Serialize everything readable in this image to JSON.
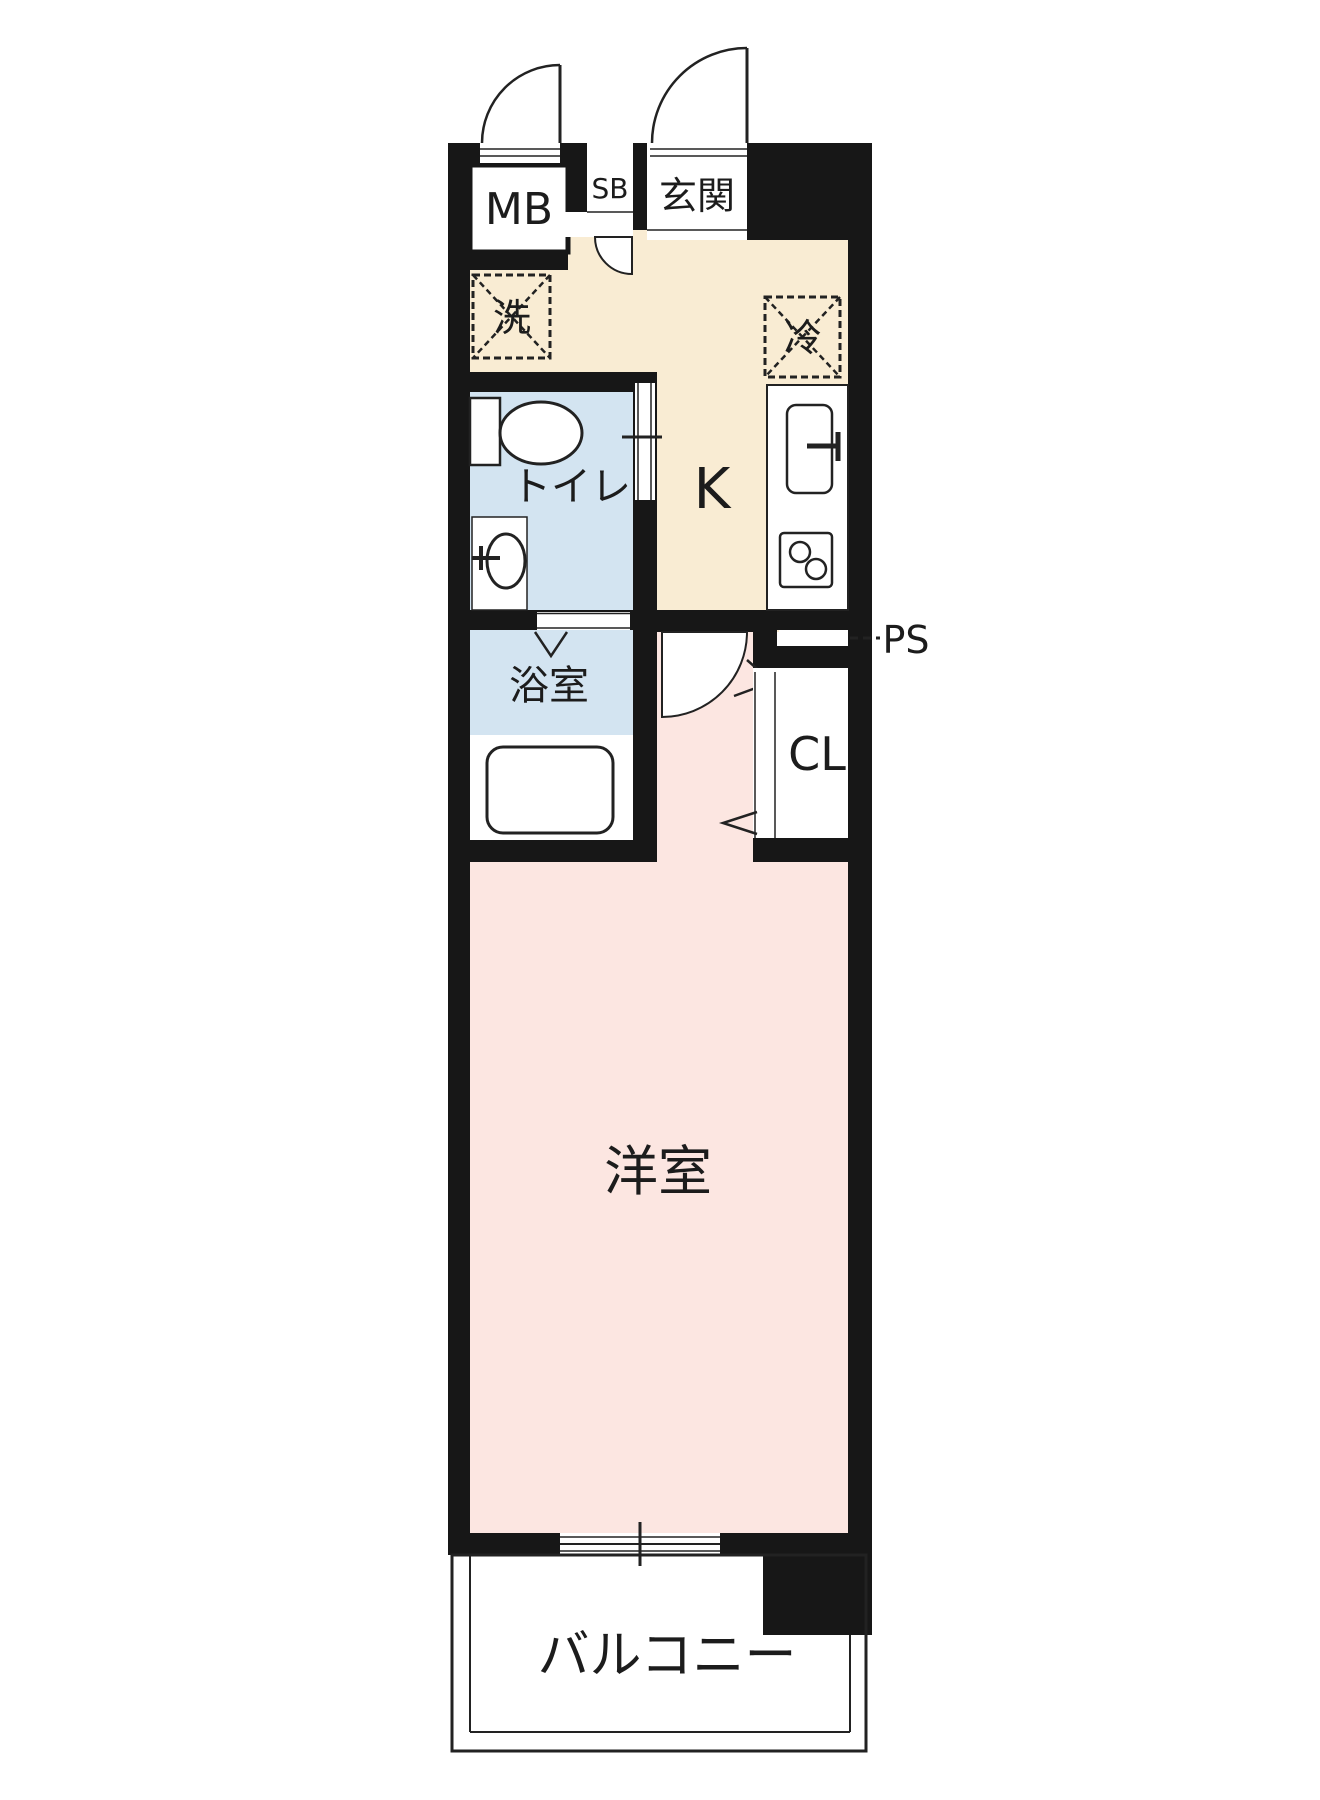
{
  "colors": {
    "wall": "#171717",
    "hall_kitchen_floor": "#f9ecd3",
    "room_floor": "#fce6e1",
    "wet_area_floor": "#d3e4f1",
    "line": "#222222"
  },
  "labels": {
    "meter_box": "MB",
    "shoe_box": "SB",
    "entrance": "玄関",
    "washing_machine": "洗",
    "refrigerator": "冷",
    "toilet": "トイレ",
    "kitchen": "K",
    "pipe_space": "PS",
    "bathroom": "浴室",
    "closet": "CL",
    "western_room": "洋室",
    "balcony": "バルコニー"
  }
}
